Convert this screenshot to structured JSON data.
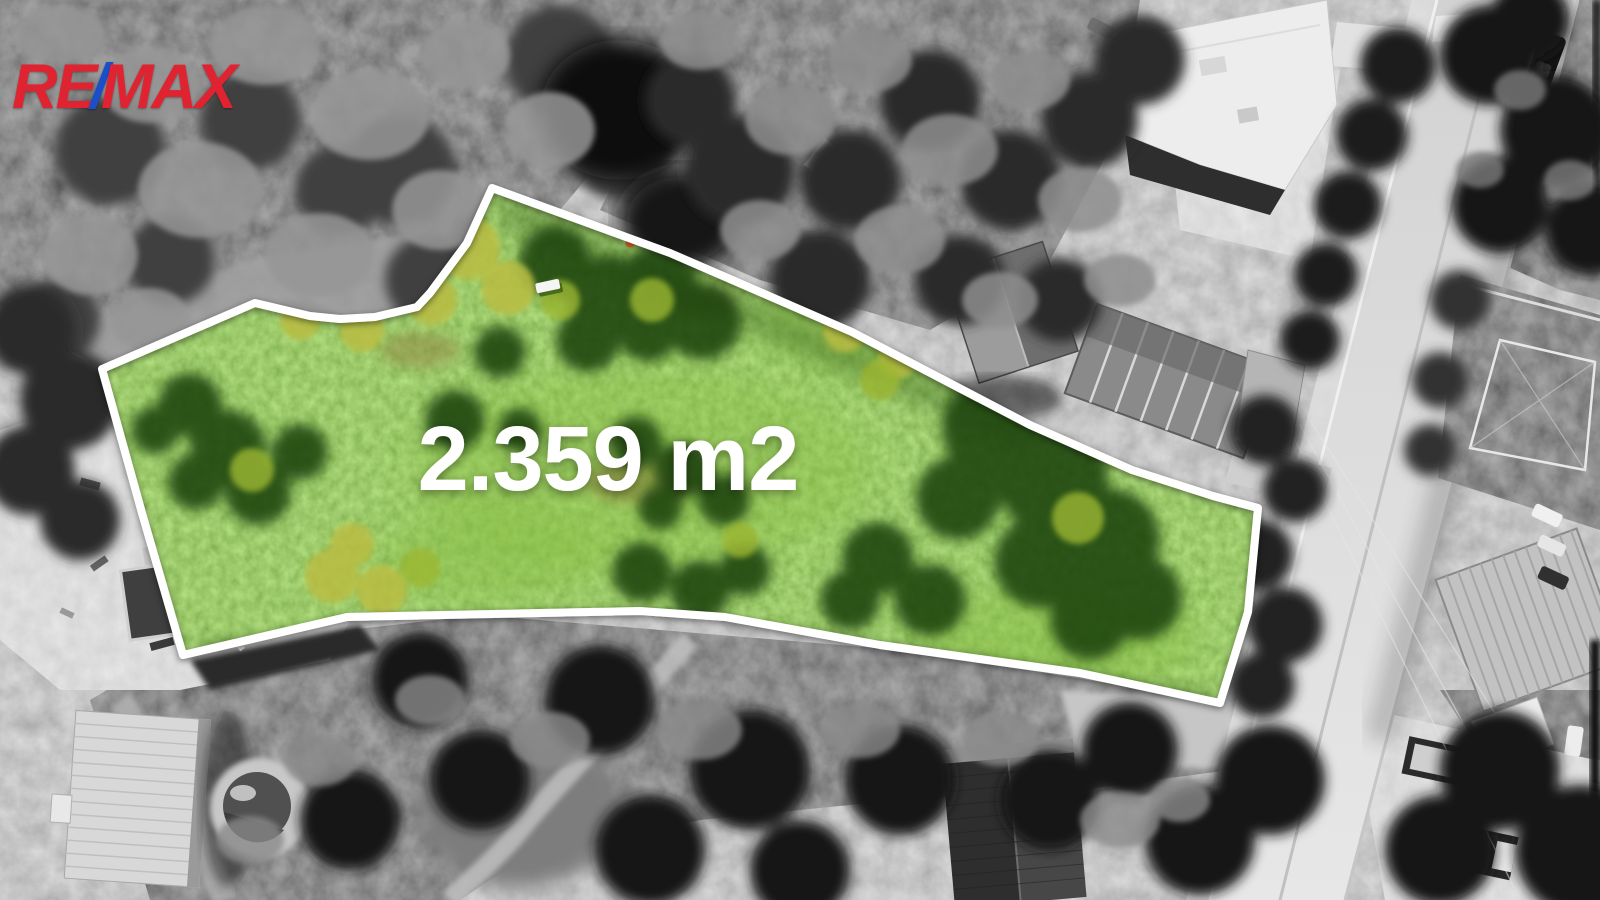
{
  "branding": {
    "logo": {
      "re": "RE",
      "slash": "/",
      "max": "MAX",
      "letter_color": "#e02330",
      "slash_color": "#1b4fc9"
    }
  },
  "plot": {
    "area_label": "2.359 m2",
    "label_color": "#ffffff",
    "outline_color": "#ffffff",
    "highlight_green": "#66a22c"
  }
}
